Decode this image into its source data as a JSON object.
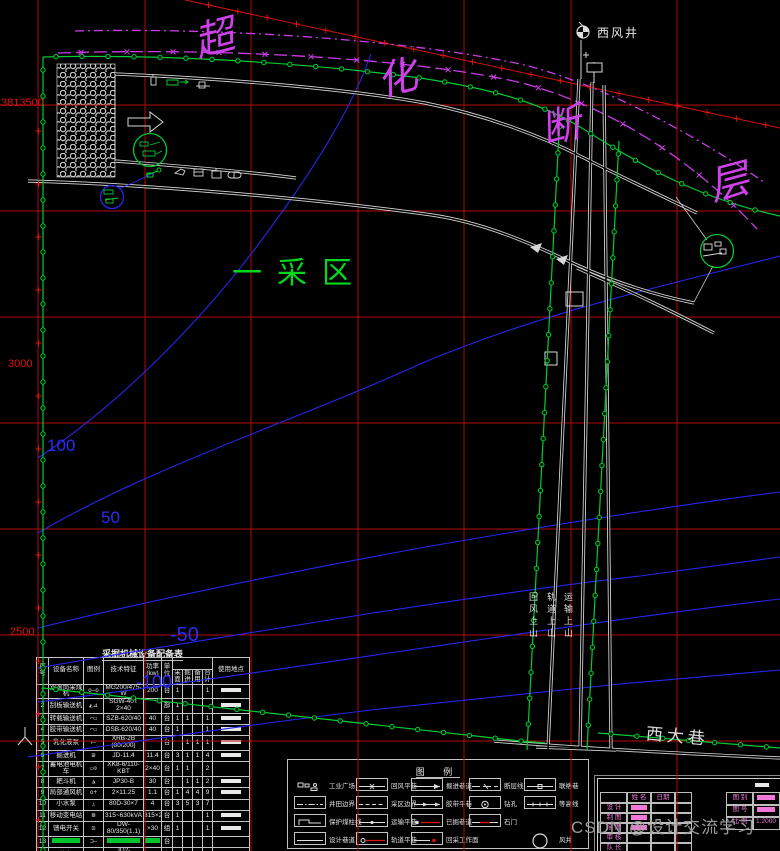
{
  "map": {
    "region_label": "一采区",
    "fault_chars": [
      "超",
      "化",
      "断",
      "层"
    ],
    "shaft_label": "西风井",
    "main_roadway_label": "西大巷",
    "incline_labels": [
      "回风上山",
      "轨道上山",
      "运输上山"
    ],
    "coord_labels": [
      "3813500",
      "3000",
      "2500"
    ],
    "contour_labels": [
      "100",
      "50",
      "-50",
      "-100"
    ]
  },
  "colors": {
    "grid": "#b40808",
    "boundary": "#00cc33",
    "contour": "#2626ee",
    "fault": "#c93ce6",
    "roadway": "#d8d8d8",
    "coord_text": "#e01010",
    "region_text": "#00d91e",
    "title_block_text": "#f078d8",
    "watermark_text": "#9b9b9b"
  },
  "equipment_table": {
    "title": "采掘机械设备配备表",
    "col_headers": [
      "序号",
      "设备名称",
      "图例",
      "技术特征",
      "功率(kw)",
      "单位",
      "使用地点"
    ],
    "qty_subheaders": [
      "采面",
      "掘进",
      "备用",
      "合计"
    ],
    "rows": [
      {
        "no": "1",
        "name": "双滚筒采煤机",
        "sym": "o—o",
        "tech": "MG200/475-W",
        "power": "200",
        "unit": "台",
        "q": [
          "1",
          "",
          "",
          "1"
        ],
        "loc": "bar",
        "green": false
      },
      {
        "no": "2",
        "name": "刮板输送机",
        "sym": "◭⊿",
        "tech": "SGW-40T 2×40",
        "power": "",
        "unit": "部",
        "q": [
          "1",
          "",
          "",
          ""
        ],
        "loc": "bar",
        "green": false
      },
      {
        "no": "3",
        "name": "转载输送机",
        "sym": "⌐▭",
        "tech": "SZB-620/40",
        "power": "40",
        "unit": "台",
        "q": [
          "1",
          "1",
          "",
          "1"
        ],
        "loc": "bar",
        "green": false
      },
      {
        "no": "4",
        "name": "胶带输送机",
        "sym": "⌐▭",
        "tech": "DSB-620/40",
        "power": "40",
        "unit": "台",
        "q": [
          "1",
          "",
          "",
          "1"
        ],
        "loc": "bar",
        "green": false
      },
      {
        "no": "5",
        "name": "乳化液泵",
        "sym": "⟝",
        "tech": "XRB-2B (80/200)",
        "power": "",
        "unit": "台",
        "q": [
          "",
          "1",
          "1",
          "1"
        ],
        "loc": "bar",
        "green": false
      },
      {
        "no": "6",
        "name": "掘进机",
        "sym": "⊞",
        "tech": "JD-11.4",
        "power": "11.4",
        "unit": "台",
        "q": [
          "3",
          "1",
          "1",
          "4"
        ],
        "loc": "bar",
        "green": false
      },
      {
        "no": "7",
        "name": "蓄电池电机车",
        "sym": "▭⊙",
        "tech": "XK8-6/110-KBT",
        "power": "2×40",
        "unit": "台",
        "q": [
          "1",
          "1",
          "",
          "2"
        ],
        "loc": "",
        "green": false
      },
      {
        "no": "8",
        "name": "耙斗机",
        "sym": "◮",
        "tech": "JP30-B",
        "power": "30",
        "unit": "台",
        "q": [
          "",
          "1",
          "1",
          "2"
        ],
        "loc": "bar",
        "green": false
      },
      {
        "no": "9",
        "name": "局部通风机",
        "sym": "o+",
        "tech": "2×11.25",
        "power": "1.1",
        "unit": "台",
        "q": [
          "1",
          "4",
          "4",
          "9"
        ],
        "loc": "bar",
        "green": false
      },
      {
        "no": "10",
        "name": "小水泵",
        "sym": "♙",
        "tech": "80D-30×7",
        "power": "4",
        "unit": "台",
        "q": [
          "3",
          "5",
          "3",
          "7"
        ],
        "loc": "",
        "green": false
      },
      {
        "no": "11",
        "name": "移动变电站",
        "sym": "⊠",
        "tech": "315~630kVA",
        "power": "315×2",
        "unit": "台",
        "q": [
          "1",
          "",
          "",
          "1"
        ],
        "loc": "bar",
        "green": false
      },
      {
        "no": "12",
        "name": "馈电开关",
        "sym": "⊡",
        "tech": "DW-80/350(1.1)",
        "power": "×30",
        "unit": "组",
        "q": [
          "1",
          "",
          "",
          "1"
        ],
        "loc": "bar",
        "green": false
      },
      {
        "no": "13",
        "name": "",
        "sym": "⊐—",
        "tech": "",
        "power": "",
        "unit": "台",
        "q": [
          "",
          "",
          "",
          ""
        ],
        "loc": "",
        "green": true
      },
      {
        "no": "14",
        "name": "绞车",
        "sym": "⟓",
        "tech": "JD2-TYD/1.25",
        "power": "",
        "unit": "台",
        "q": [
          "1",
          "",
          "",
          "1"
        ],
        "loc": "bar",
        "green": false
      },
      {
        "no": "15",
        "name": "安全监测分站",
        "sym": "⌐▯",
        "tech": "KJ-101",
        "power": "1.0",
        "unit": "台",
        "q": [
          "",
          "1",
          "",
          "1"
        ],
        "loc": "bar",
        "green": false
      }
    ]
  },
  "legend": {
    "title": "图 例",
    "items": [
      {
        "label": "工业广场",
        "sample": "icons",
        "col": 0,
        "row": 0
      },
      {
        "label": "井田边界",
        "sample": "dashdot",
        "col": 0,
        "row": 1
      },
      {
        "label": "保护煤柱线",
        "sample": "bracket",
        "col": 0,
        "row": 2
      },
      {
        "label": "设计巷道",
        "sample": "solid",
        "col": 0,
        "row": 3
      },
      {
        "label": "回风平巷",
        "sample": "line-x",
        "col": 1,
        "row": 0
      },
      {
        "label": "采区边界",
        "sample": "dashed",
        "col": 1,
        "row": 1
      },
      {
        "label": "运输平巷",
        "sample": "line-dot",
        "col": 1,
        "row": 2
      },
      {
        "label": "轨道平巷",
        "sample": "circle-red",
        "col": 1,
        "row": 3
      },
      {
        "label": "掘进巷道",
        "sample": "line-arrow",
        "col": 2,
        "row": 0
      },
      {
        "label": "胶带平巷",
        "sample": "line-arrow2",
        "col": 2,
        "row": 1
      },
      {
        "label": "已掘巷道",
        "sample": "dot-red",
        "col": 2,
        "row": 2
      },
      {
        "label": "回采工作面",
        "sample": "dot-red2",
        "col": 2,
        "row": 3
      },
      {
        "label": "断层线",
        "sample": "line-dash",
        "col": 3,
        "row": 0
      },
      {
        "label": "钻孔",
        "sample": "circle-dot",
        "col": 3,
        "row": 1
      },
      {
        "label": "石门",
        "sample": "red-seg",
        "col": 3,
        "row": 2
      },
      {
        "label": "联络巷",
        "sample": "line-mid",
        "col": 4,
        "row": 0
      },
      {
        "label": "等高线",
        "sample": "line-tick",
        "col": 4,
        "row": 1
      },
      {
        "label": "风井",
        "sample": "big-circle",
        "col": 4,
        "row": 3
      }
    ]
  },
  "title_block": {
    "name_col_header": "姓 名",
    "date_col_header": "日期",
    "left_rows": [
      "设 计",
      "制 图",
      "描 图",
      "审 核",
      "队 长"
    ],
    "right_rows": [
      {
        "label": "图 别",
        "value": ""
      },
      {
        "label": "图 号",
        "value": ""
      },
      {
        "label": "比 例",
        "value": "1:2000"
      }
    ]
  },
  "watermark": "CSDN @设计交流学习"
}
